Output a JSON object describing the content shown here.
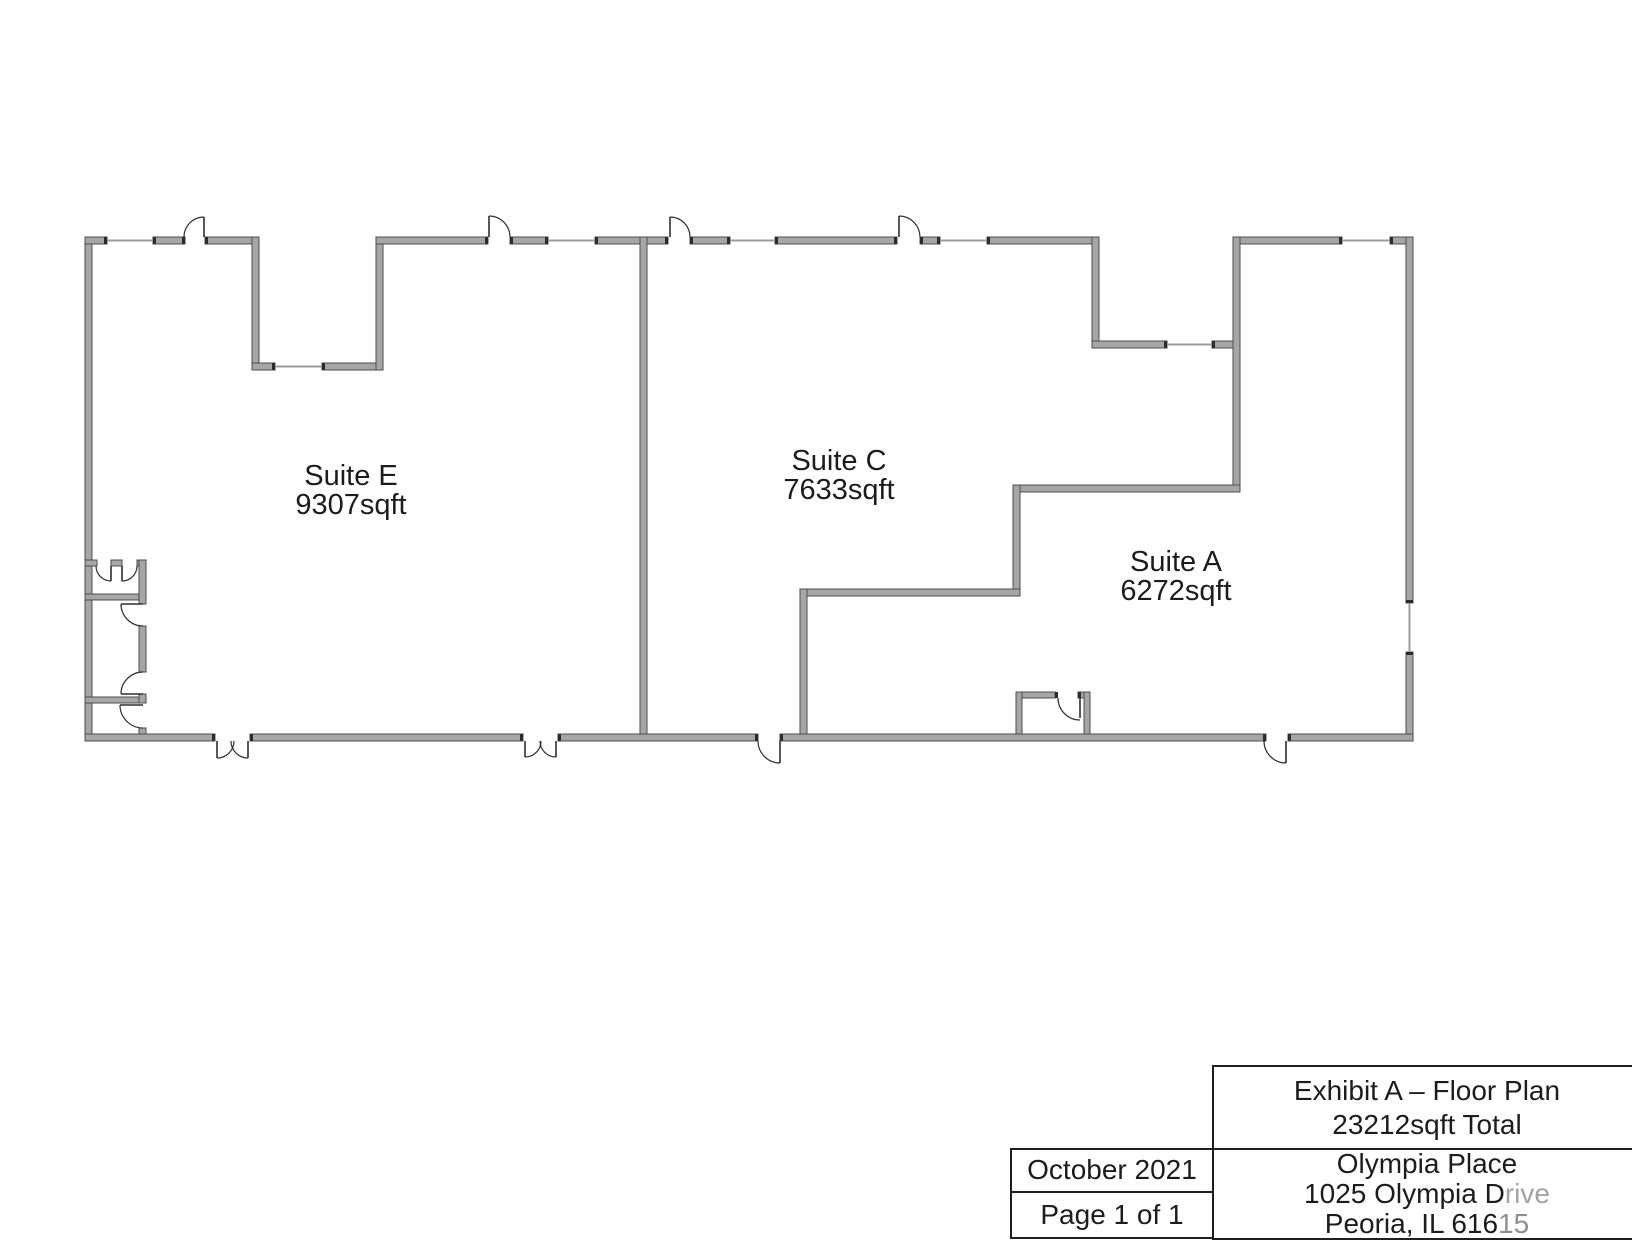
{
  "page": {
    "width": 1632,
    "height": 1232,
    "background": "#ffffff"
  },
  "floor_plan": {
    "colors": {
      "wall_fill": "#a6a6a6",
      "wall_stroke": "#4d4d4d",
      "cap": "#2b2b2b",
      "window": "#9c9c9c",
      "door": "#2f2f2f",
      "label": "#1c1c1c"
    },
    "suites": [
      {
        "name": "Suite E",
        "area": "9307sqft",
        "cx": 351,
        "name_y": 485,
        "area_y": 514
      },
      {
        "name": "Suite C",
        "area": "7633sqft",
        "cx": 839,
        "name_y": 470,
        "area_y": 499
      },
      {
        "name": "Suite A",
        "area": "6272sqft",
        "cx": 1176,
        "name_y": 571,
        "area_y": 600
      }
    ],
    "walls": [
      [
        85,
        237,
        7,
        504
      ],
      [
        85,
        237,
        22,
        7
      ],
      [
        153,
        237,
        32,
        7
      ],
      [
        205,
        237,
        47,
        7
      ],
      [
        252,
        237,
        7,
        133
      ],
      [
        252,
        363,
        23,
        7
      ],
      [
        322,
        363,
        54,
        7
      ],
      [
        376,
        237,
        7,
        133
      ],
      [
        376,
        237,
        112,
        7
      ],
      [
        510,
        237,
        38,
        7
      ],
      [
        595,
        237,
        45,
        7
      ],
      [
        640,
        237,
        7,
        504
      ],
      [
        647,
        237,
        21,
        7
      ],
      [
        690,
        237,
        40,
        7
      ],
      [
        775,
        237,
        122,
        7
      ],
      [
        920,
        237,
        20,
        7
      ],
      [
        987,
        237,
        112,
        7
      ],
      [
        1092,
        237,
        7,
        111
      ],
      [
        1092,
        341,
        75,
        7
      ],
      [
        1212,
        341,
        28,
        7
      ],
      [
        1233,
        237,
        7,
        255
      ],
      [
        1240,
        237,
        102,
        7
      ],
      [
        1390,
        237,
        23,
        7
      ],
      [
        1406,
        237,
        7,
        366
      ],
      [
        1406,
        652,
        7,
        89
      ],
      [
        1013,
        485,
        227,
        7
      ],
      [
        1013,
        485,
        7,
        111
      ],
      [
        800,
        589,
        220,
        7
      ],
      [
        800,
        589,
        7,
        152
      ],
      [
        85,
        734,
        130,
        7
      ],
      [
        250,
        734,
        273,
        7
      ],
      [
        558,
        734,
        200,
        7
      ],
      [
        780,
        734,
        486,
        7
      ],
      [
        1288,
        734,
        125,
        7
      ],
      [
        1016,
        692,
        39,
        6
      ],
      [
        1078,
        692,
        12,
        6
      ],
      [
        1016,
        692,
        6,
        42
      ],
      [
        1084,
        692,
        6,
        42
      ],
      [
        85,
        560,
        12,
        6
      ],
      [
        111,
        560,
        11,
        6
      ],
      [
        137,
        560,
        9,
        6
      ],
      [
        85,
        594,
        61,
        6
      ],
      [
        85,
        697,
        61,
        6
      ],
      [
        139,
        560,
        7,
        44
      ],
      [
        139,
        626,
        7,
        46
      ],
      [
        139,
        694,
        7,
        9
      ],
      [
        139,
        728,
        7,
        6
      ]
    ],
    "caps": [
      [
        104,
        237,
        3,
        7
      ],
      [
        153,
        237,
        3,
        7
      ],
      [
        545,
        237,
        3,
        7
      ],
      [
        595,
        237,
        3,
        7
      ],
      [
        727,
        237,
        3,
        7
      ],
      [
        775,
        237,
        3,
        7
      ],
      [
        937,
        237,
        3,
        7
      ],
      [
        987,
        237,
        3,
        7
      ],
      [
        1339,
        237,
        3,
        7
      ],
      [
        1390,
        237,
        3,
        7
      ],
      [
        272,
        363,
        3,
        7
      ],
      [
        322,
        363,
        3,
        7
      ],
      [
        1164,
        341,
        3,
        7
      ],
      [
        1212,
        341,
        3,
        7
      ],
      [
        1406,
        600,
        7,
        3
      ],
      [
        1406,
        652,
        7,
        3
      ],
      [
        182,
        237,
        3,
        7
      ],
      [
        205,
        237,
        3,
        7
      ],
      [
        485,
        237,
        3,
        7
      ],
      [
        510,
        237,
        3,
        7
      ],
      [
        665,
        237,
        3,
        7
      ],
      [
        690,
        237,
        3,
        7
      ],
      [
        894,
        237,
        3,
        7
      ],
      [
        920,
        237,
        3,
        7
      ],
      [
        212,
        734,
        3,
        7
      ],
      [
        250,
        734,
        3,
        7
      ],
      [
        520,
        734,
        3,
        7
      ],
      [
        558,
        734,
        3,
        7
      ],
      [
        755,
        734,
        3,
        7
      ],
      [
        780,
        734,
        3,
        7
      ],
      [
        1263,
        734,
        3,
        7
      ],
      [
        1288,
        734,
        3,
        7
      ],
      [
        1055,
        692,
        3,
        6
      ],
      [
        1078,
        692,
        3,
        6
      ]
    ],
    "windows": [
      [
        107,
        240.5,
        153,
        240.5
      ],
      [
        548,
        240.5,
        595,
        240.5
      ],
      [
        730,
        240.5,
        775,
        240.5
      ],
      [
        940,
        240.5,
        987,
        240.5
      ],
      [
        1342,
        240.5,
        1390,
        240.5
      ],
      [
        275,
        366.5,
        322,
        366.5
      ],
      [
        1167,
        344.5,
        1212,
        344.5
      ],
      [
        1409.5,
        603,
        1409.5,
        652
      ]
    ],
    "doors": [
      {
        "leaf": [
          204,
          237,
          204,
          217
        ],
        "arc": "M 204 217 A 20 20 0 0 0 184 237"
      },
      {
        "leaf": [
          489,
          237,
          489,
          216
        ],
        "arc": "M 489 216 A 21 21 0 0 1 510 237"
      },
      {
        "leaf": [
          670,
          237,
          670,
          217
        ],
        "arc": "M 670 217 A 20 20 0 0 1 690 237"
      },
      {
        "leaf": [
          899,
          237,
          899,
          216
        ],
        "arc": "M 899 216 A 21 21 0 0 1 920 237"
      },
      {
        "leaf": [
          217,
          741,
          217,
          758
        ],
        "arc": "M 217 758 A 17 17 0 0 0 234 741"
      },
      {
        "leaf": [
          248,
          741,
          248,
          758
        ],
        "arc": "M 248 758 A 17 17 0 0 1 231 741"
      },
      {
        "leaf": [
          525,
          741,
          525,
          757
        ],
        "arc": "M 525 757 A 16 16 0 0 0 541 741"
      },
      {
        "leaf": [
          556,
          741,
          556,
          757
        ],
        "arc": "M 556 757 A 16 16 0 0 1 540 741"
      },
      {
        "leaf": [
          780,
          741,
          780,
          763
        ],
        "arc": "M 780 763 A 22 22 0 0 1 758 741"
      },
      {
        "leaf": [
          1286,
          741,
          1286,
          763
        ],
        "arc": "M 1286 763 A 22 22 0 0 1 1264 741"
      },
      {
        "leaf": [
          1080,
          698,
          1080,
          718
        ],
        "arc": "M 1058 698 A 22 22 0 0 0 1080 720"
      },
      {
        "leaf": [
          111,
          566,
          111,
          581
        ],
        "arc": "M 111 581 A 15 15 0 0 1 96 566"
      },
      {
        "leaf": [
          122,
          566,
          122,
          581
        ],
        "arc": "M 122 581 A 15 15 0 0 0 137 566"
      },
      {
        "leaf": [
          143,
          604,
          121,
          604
        ],
        "arc": "M 121 604 A 22 22 0 0 0 143 626"
      },
      {
        "leaf": [
          143,
          694,
          121,
          694
        ],
        "arc": "M 121 694 A 22 22 0 0 1 143 672"
      },
      {
        "leaf": [
          143,
          705,
          120,
          705
        ],
        "arc": "M 120 705 A 23 23 0 0 0 143 728"
      }
    ]
  },
  "title_block": {
    "title_line1": "Exhibit A – Floor Plan",
    "title_line2": "23212sqft Total",
    "date": "October 2021",
    "page": "Page 1 of 1",
    "address_line1": "Olympia Place",
    "address_line2_main": "1025 Olympia D",
    "address_line2_faded": "rive",
    "address_line3_main": "Peoria, IL 616",
    "address_line3_faded": "15"
  }
}
